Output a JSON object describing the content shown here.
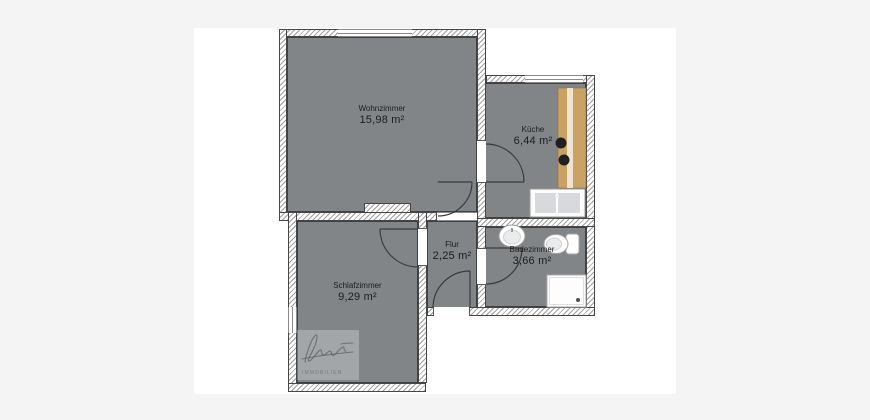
{
  "page": {
    "background": "#f4f4f5",
    "canvas": "#ffffff"
  },
  "palette": {
    "floor": "#828588",
    "wall_outline": "#464646",
    "hatch_line": "#9f9f9f",
    "door_line": "#3a3a3e",
    "counter_wood": "#c9a264",
    "counter_stripe": "#ede5cf",
    "fixture_outline": "#a5a5a5",
    "fixture_fill": "#e9ebee"
  },
  "rooms": [
    {
      "name": "Wohnzimmer",
      "area": "15,98 m²"
    },
    {
      "name": "Küche",
      "area": "6,44 m²"
    },
    {
      "name": "Flur",
      "area": "2,25 m²"
    },
    {
      "name": "Badezimmer",
      "area": "3,66 m²"
    },
    {
      "name": "Schlafzimmer",
      "area": "9,29 m²"
    }
  ],
  "fixtures": [
    "kitchen-counter",
    "stove-knobs",
    "kitchen-sink",
    "bathroom-sink",
    "toilet",
    "shower"
  ],
  "watermark": {
    "text": "IMMOBILIEN"
  }
}
